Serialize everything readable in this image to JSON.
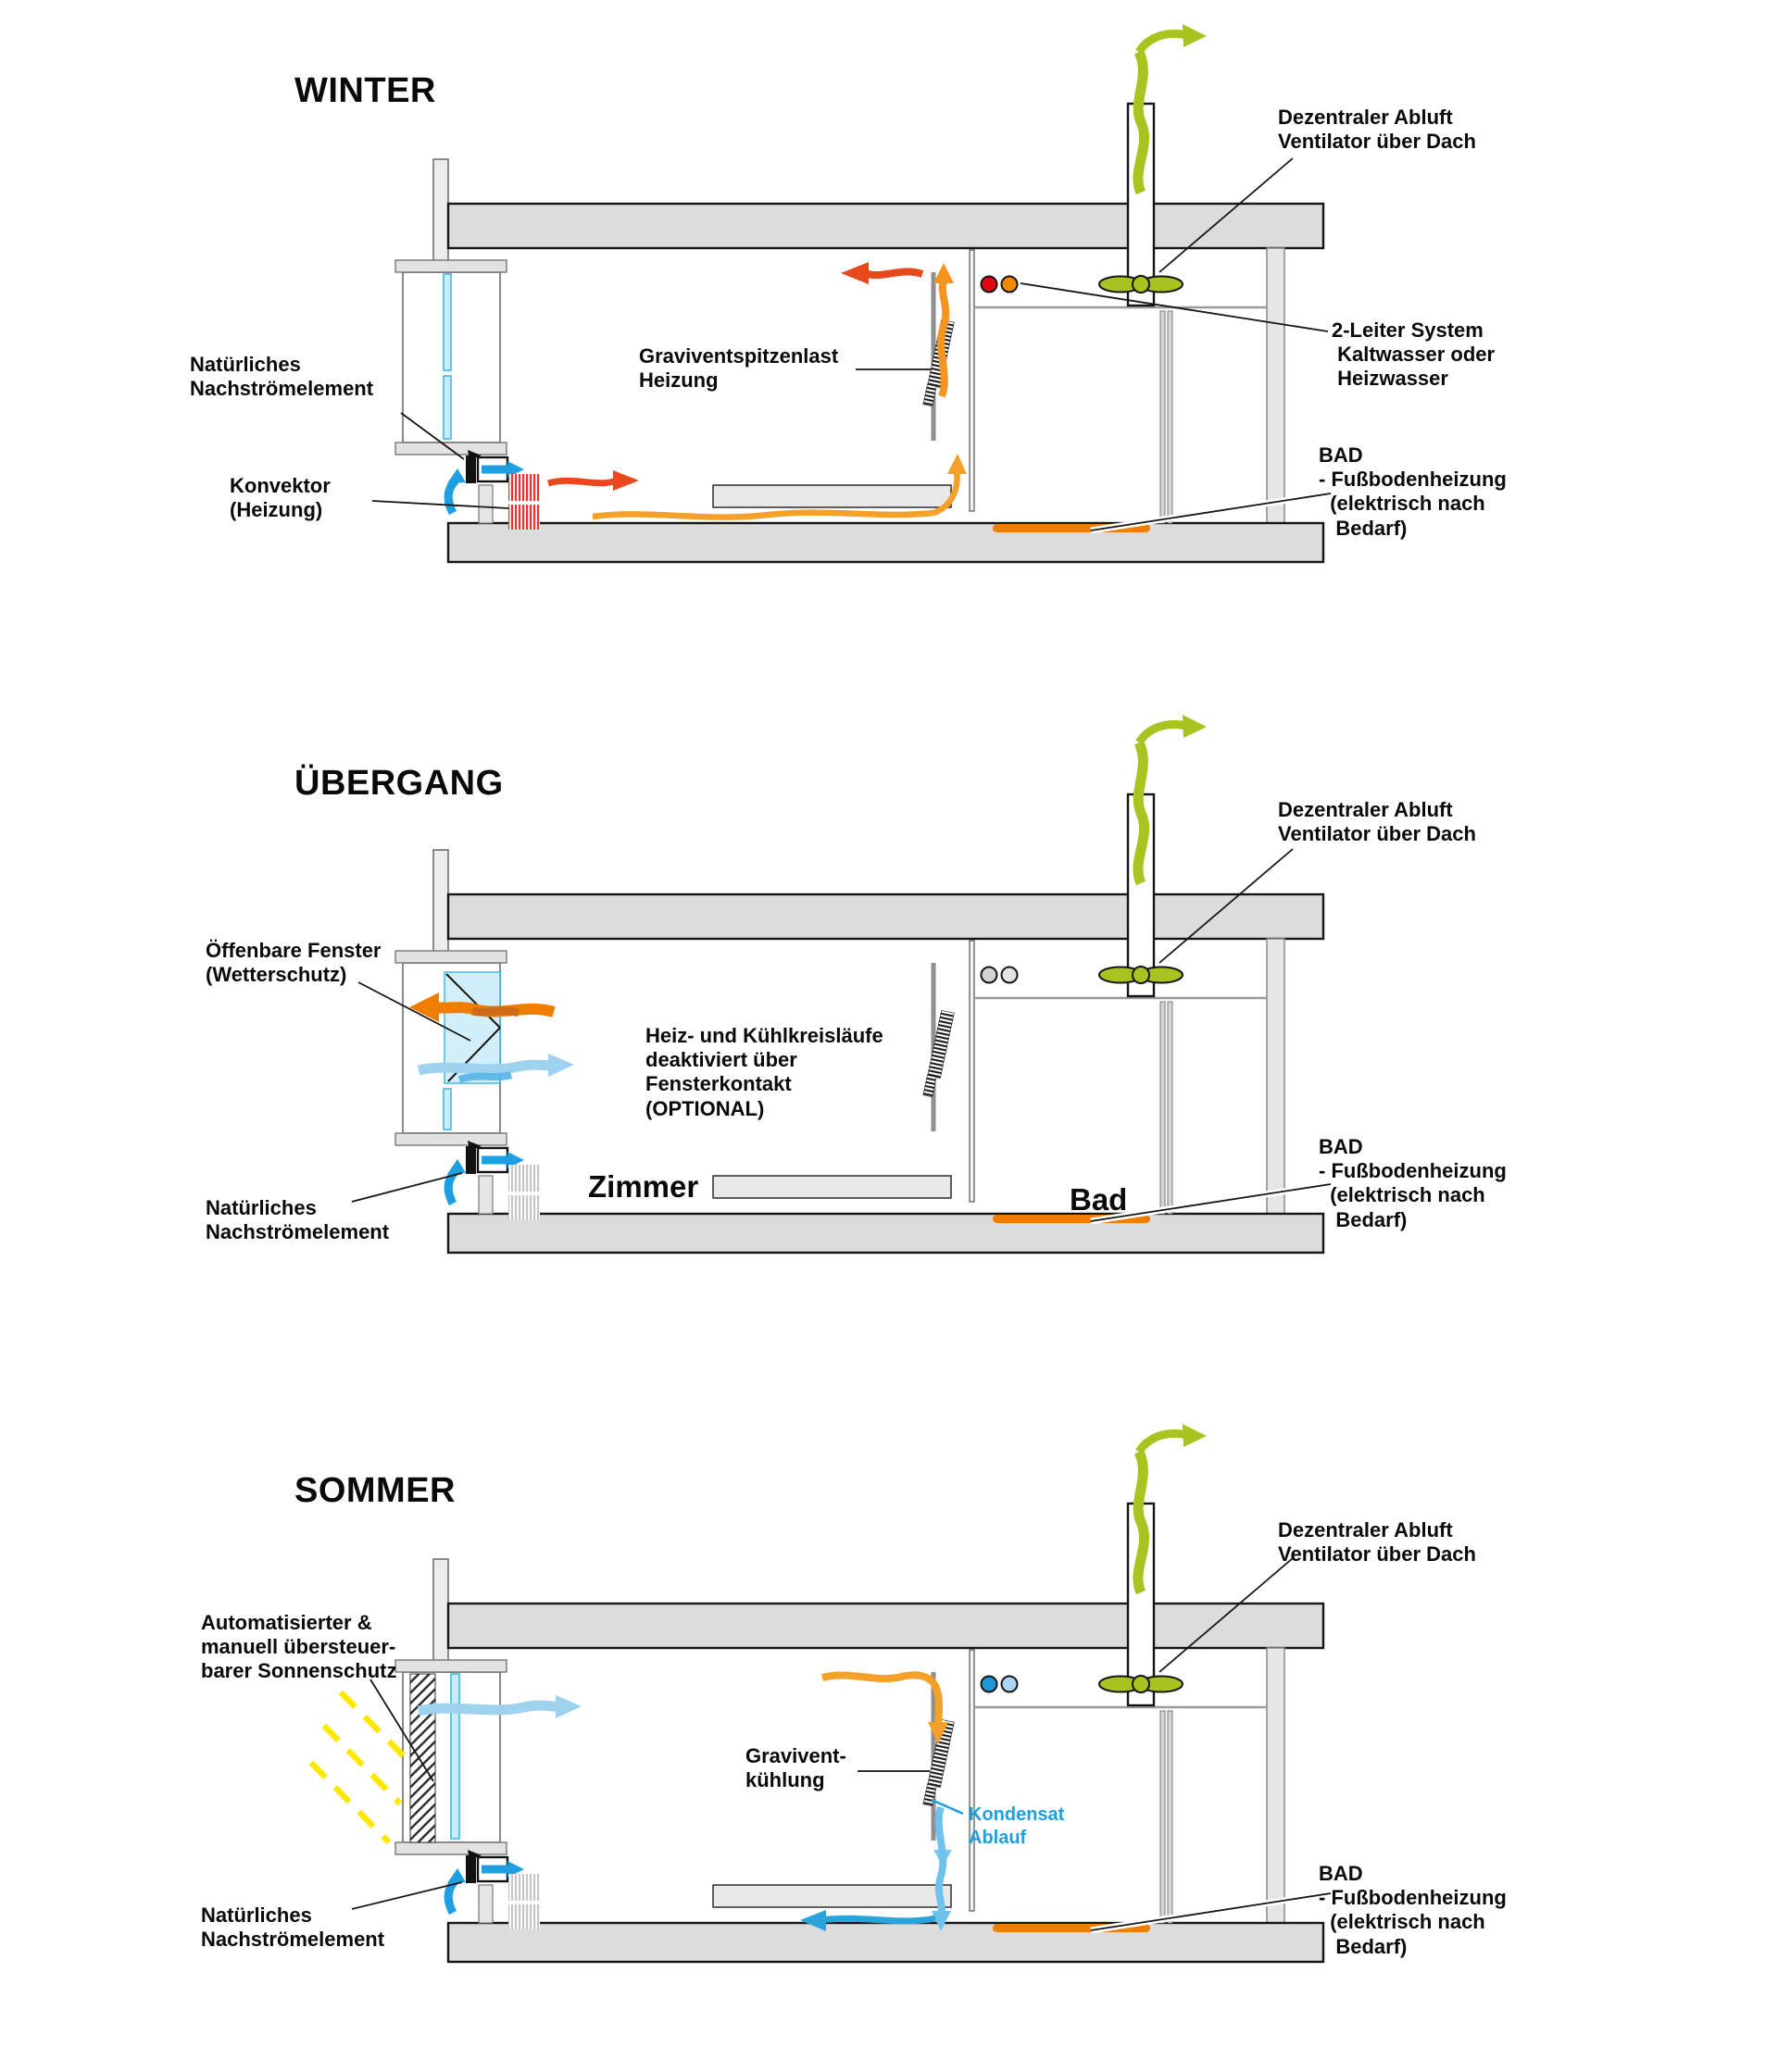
{
  "colors": {
    "structure_gray": "#dcdcdc",
    "exhaust_green": "#a8c420",
    "warm_red": "#e8481c",
    "warm_orange": "#f5941e",
    "floor_heating_orange": "#ef7d00",
    "cool_blue": "#1d9fe0",
    "light_blue": "#9ed3ef",
    "glass_blue": "#c8ecfa",
    "sun_yellow": "#ffe800",
    "valve_red": "#e30613",
    "valve_orange": "#f08a00",
    "valve_blue_dark": "#1f97d4",
    "valve_blue_light": "#a8d6f0",
    "valve_gray_dark": "#d2d2d2",
    "valve_gray_light": "#e4e4e4"
  },
  "sections": [
    {
      "id": "winter",
      "title": "WINTER",
      "labels": {
        "nachstroemelement": "Natürliches\nNachströmelement",
        "konvektor": "Konvektor\n(Heizung)",
        "graviventspitzenlast": "Graviventspitzenlast\nHeizung",
        "abluft_ventilator": "Dezentraler Abluft\nVentilator über Dach",
        "zweileiter": "2-Leiter System\n Kaltwasser oder\n Heizwasser",
        "bad_fussbodenheizung": "BAD\n- Fußbodenheizung\n  (elektrisch nach\n   Bedarf)"
      }
    },
    {
      "id": "uebergang",
      "title": "ÜBERGANG",
      "labels": {
        "oeffenbare_fenster": "Öffenbare Fenster\n(Wetterschutz)",
        "heizkuehlkreislaeufe": "Heiz- und Kühlkreisläufe\ndeaktiviert über\nFensterkontakt\n(OPTIONAL)",
        "zimmer": "Zimmer",
        "bad_raum": "Bad",
        "nachstroemelement": "Natürliches\nNachströmelement",
        "abluft_ventilator": "Dezentraler Abluft\nVentilator über Dach",
        "bad_fussbodenheizung": "BAD\n- Fußbodenheizung\n  (elektrisch nach\n   Bedarf)"
      }
    },
    {
      "id": "sommer",
      "title": "SOMMER",
      "labels": {
        "sonnenschutz": "Automatisierter &\nmanuell übersteuer-\nbarer Sonnenschutz",
        "graviventkuehlung": "Gravivent-\nkühlung",
        "kondensat": "Kondensat\nAblauf",
        "nachstroemelement": "Natürliches\nNachströmelement",
        "abluft_ventilator": "Dezentraler Abluft\nVentilator über Dach",
        "bad_fussbodenheizung": "BAD\n- Fußbodenheizung\n  (elektrisch nach\n   Bedarf)"
      }
    }
  ]
}
